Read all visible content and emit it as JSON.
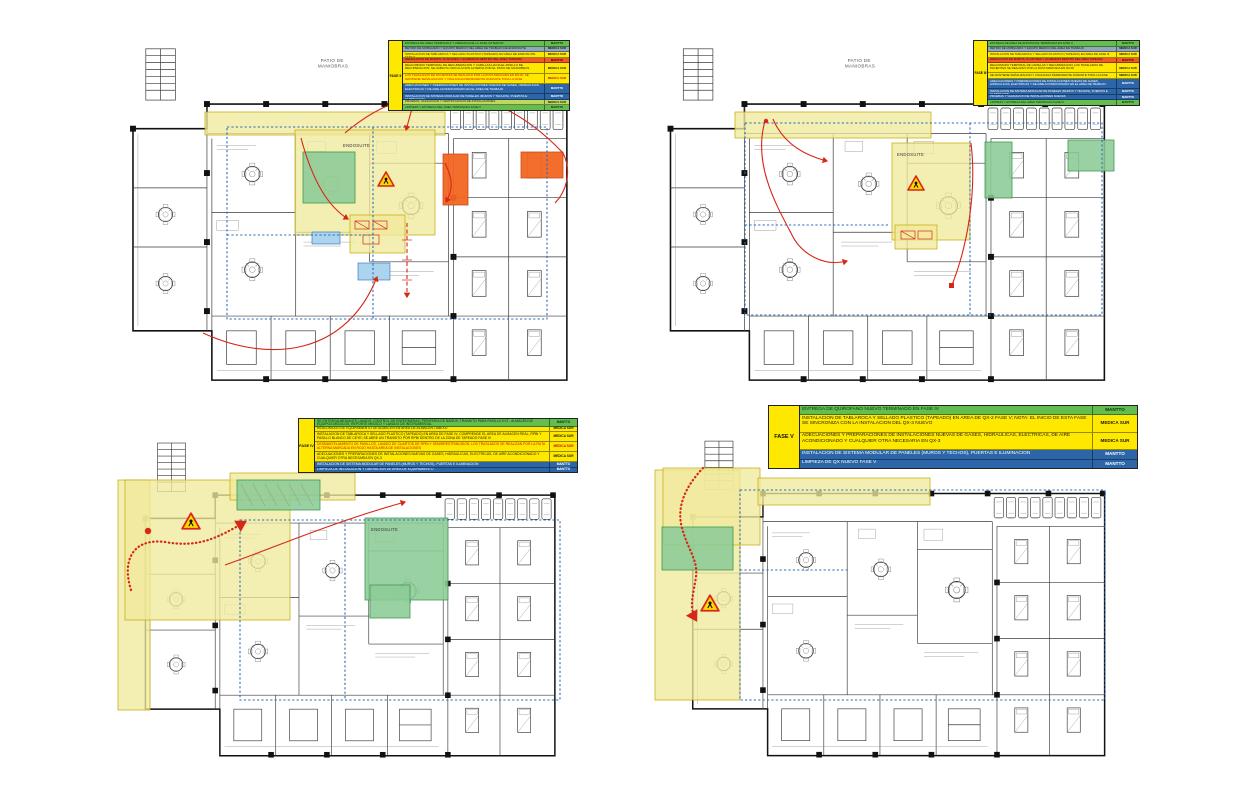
{
  "document": {
    "type": "hospital-renovation-phasing-plans",
    "background": "#ffffff"
  },
  "colors": {
    "legend_green": "#63BE4F",
    "legend_lightgreen": "#BCD85F",
    "legend_grayblue": "#93A7BB",
    "legend_yellow": "#FFE800",
    "legend_orange": "#F05A28",
    "legend_blue": "#2C66A9",
    "zone_yellow": "#EFE99B",
    "zone_green": "#8CCB96",
    "zone_orange": "#F26522",
    "zone_blue_note": "#A8D2EE",
    "route_red": "#D62718",
    "boundary_blue": "#2E6CB5",
    "warning_yellow": "#FFD800",
    "warning_red": "#D62718"
  },
  "plans": [
    {
      "name": "top-left",
      "patio_label_line1": "PATIO DE",
      "patio_label_line2": "MANIOBRAS",
      "endosuite_label": "ENDOSUITE",
      "legend": {
        "phase_label": "FASE II",
        "rows": [
          {
            "color": "green",
            "lines": 1,
            "text": "ENTREGA DE AREA TERMINADA Y LIBERADA DE LA FASE ANTERIOR",
            "resp": "MANTTO"
          },
          {
            "color": "grayblue",
            "lines": 1,
            "text": "RETIRO DE MOBILIARIO Y EQUIPO MEDICO DEL AREA DE TRABAJO DE ENDOSUITE",
            "resp": "MEDICA SUR"
          },
          {
            "color": "yellow",
            "lines": 1,
            "text": "INSTALACION DE TABLAROCA Y SELLADO PLASTICO (TAPEADO) EN AREA DE ENDOSUITE FASE II",
            "resp": "MEDICA SUR"
          },
          {
            "color": "orange",
            "lines": 1,
            "text": "DEMOLICION DE MUROS, PLAFONES Y ACABADOS DENTRO DEL AREA TAPEADA",
            "resp": "MANTTO"
          },
          {
            "color": "yellow",
            "lines": 2,
            "text": "REACOMODO TEMPORAL DE RECUPERACION Y CAMILLAS HACIA EL PASILLO DE RECUPERACION; SE HABILITA CIRCULACION ALTERNA POR EL PATIO DE MANIOBRAS",
            "resp": "MEDICA SUR"
          },
          {
            "color": "yellowred",
            "lines": 2,
            "text": "LOS TRASLADOS DE PACIENTES SE REALIZAN POR LA RUTA MARCADA EN ROJO; SE MANTIENE SEÑALIZACION Y VIGILANCIA PERMANENTE DURANTE TODA LA FASE",
            "resp": "MEDICA SUR"
          },
          {
            "color": "blue",
            "lines": 2,
            "text": "ADECUACIONES Y PREPARACIONES DE INSTALACIONES NUEVAS DE GASES, HIDRAULICAS, ELECTRICAS Y DE AIRE ACONDICIONADO EN EL AREA DE TRABAJO",
            "resp": "MANTTO"
          },
          {
            "color": "blue",
            "lines": 1,
            "text": "INSTALACION DE SISTEMA MODULAR DE PANELES (MUROS Y TECHOS), PUERTAS E ILUMINACION",
            "resp": "MANTTO"
          },
          {
            "color": "lightgreen",
            "lines": 1,
            "text": "PRUEBAS, VALIDACION Y CERTIFICACION DE INSTALACIONES",
            "resp": "MEDICA SUR"
          },
          {
            "color": "green",
            "lines": 1,
            "text": "LIMPIEZA Y ENTREGA DEL AREA TERMINADA FASE II",
            "resp": "MANTTO"
          }
        ]
      }
    },
    {
      "name": "top-right",
      "patio_label_line1": "PATIO DE",
      "patio_label_line2": "MANIOBRAS",
      "endosuite_label": "ENDOSUITE",
      "legend": {
        "phase_label": "FASE III",
        "rows": [
          {
            "color": "green",
            "lines": 1,
            "text": "ENTREGA DE AREA DE ENDOSUITE TERMINADA EN FASE II",
            "resp": "MANTTO"
          },
          {
            "color": "grayblue",
            "lines": 1,
            "text": "RETIRO DE MOBILIARIO Y EQUIPO MEDICO DEL AREA DE TRABAJO",
            "resp": "MEDICA SUR"
          },
          {
            "color": "yellow",
            "lines": 1,
            "text": "INSTALACION DE TABLAROCA Y SELLADO PLASTICO (TAPEADO) EN AREA DE FASE III",
            "resp": "MEDICA SUR"
          },
          {
            "color": "orange",
            "lines": 1,
            "text": "DEMOLICION DE MUROS, PLAFONES Y ACABADOS DENTRO DEL AREA TAPEADA",
            "resp": "MANTTO"
          },
          {
            "color": "yellow",
            "lines": 2,
            "text": "REACOMODO TEMPORAL DE CAMILLAS Y RECUPERACION; LOS TRASLADOS DE PACIENTES SE REALIZAN POR LA RUTA MARCADA EN ROJO",
            "resp": "MEDICA SUR"
          },
          {
            "color": "yellow",
            "lines": 1,
            "text": "SE MANTIENE SEÑALIZACION Y VIGILANCIA PERMANENTE DURANTE TODA LA FASE",
            "resp": "MEDICA SUR"
          },
          {
            "color": "blue",
            "lines": 2,
            "text": "ADECUACIONES Y PREPARACIONES DE INSTALACIONES NUEVAS DE GASES, HIDRAULICAS, ELECTRICAS Y DE AIRE ACONDICIONADO EN EL AREA DE TRABAJO",
            "resp": "MANTTO"
          },
          {
            "color": "blue",
            "lines": 1,
            "text": "INSTALACION DE SISTEMA MODULAR DE PANELES (MUROS Y TECHOS), PUERTAS E ILUMINACION",
            "resp": "MANTTO"
          },
          {
            "color": "blue",
            "lines": 1,
            "text": "PRUEBAS Y VALIDACION DE INSTALACIONES NUEVAS",
            "resp": "MANTTO"
          },
          {
            "color": "green",
            "lines": 1,
            "text": "LIMPIEZA Y ENTREGA DEL AREA TERMINADA FASE III",
            "resp": "MANTTO"
          }
        ]
      }
    },
    {
      "name": "bottom-left",
      "endosuite_label": "ENDOSUITE",
      "legend": {
        "phase_label": "FASE IV",
        "rows": [
          {
            "color": "green",
            "lines": 1.5,
            "text": "SE ENTREGA MEDIANTE LAVADO: CONTROL DE ENFERMERAS, PERIFERIA DE BAÑOS, TRANSITO PARA PASILLO EXT., ALMACEN DE EQUIPOS MEDICOS, REPORTE MEDICO Y LAVADO DE INSTRUMENTAL",
            "resp": "MANTTO"
          },
          {
            "color": "yellow",
            "lines": 1,
            "text": "REACOMODO DE EQUIPAMIENTO DE ALMACEN EN AREA DE ALMACEN / ANEXO",
            "resp": "MEDICA SUR"
          },
          {
            "color": "yellow",
            "lines": 2,
            "text": "INSTALACION DE TABLAROCA Y SELLADO PLASTICO (TAPEADO) EN AREA DE FASE IV; COMPRENDE EL AREA DE ALMACEN REAL, RPBI Y PASILLO BLANCO DE CEYE; SE ABRE UN TRANSITO POR RPBI DENTRO DE LA ZONA DE TAPEADO FASE IV",
            "resp": "MEDICA SUR"
          },
          {
            "color": "yellowred",
            "lines": 2,
            "text": "DESMANTELAMIENTO DE PASILLOS, LAVADO DE CUARTOS DE RPBI Y SEMIRRESTRINGIDOS; LOS TRASLADOS SE REALIZAN POR LA RUTA ALTERNA MARCADA EN ROJO HASTA AREA DE INSTALACIONES",
            "resp": "MEDICA SUR"
          },
          {
            "color": "yellow",
            "lines": 2,
            "text": "ADECUACIONES Y PREPARACIONES DE INSTALACIONES NUEVAS DE GASES, HIDRAULICAS, ELECTRICAS, DE AIRE ACONDICIONADO Y CUALQUIER OTRA NECESARIA EN QX-3",
            "resp": "MEDICA SUR"
          },
          {
            "color": "blue",
            "lines": 1,
            "text": "INSTALACION DE SISTEMA MODULAR DE PANELES (MUROS Y TECHOS), PUERTAS E ILUMINACION",
            "resp": "MANTTO"
          },
          {
            "color": "blue",
            "lines": 1,
            "text": "LIMPIEZA DE INSTALACION Y LIBERACION DE AREA DE EQUIPAMIENTO",
            "resp": "MANTTO"
          }
        ]
      }
    },
    {
      "name": "bottom-right",
      "legend": {
        "phase_label": "FASE V",
        "rows": [
          {
            "color": "green",
            "lines": 1,
            "text": "ENTREGA DE QUIROFANO NUEVO TERMINADO EN FASE IV",
            "resp": "MANTTO"
          },
          {
            "color": "yellow",
            "lines": 2,
            "text": "INSTALACION DE TABLAROCA Y SELLADO PLASTICO (TAPEADO) EN AREA DE QX-2 FASE V; NOTA: EL INICIO DE ESTA FASE SE SINCRONIZA CON LA INSTALACION DEL QX-3 NUEVO",
            "resp": "MEDICA SUR"
          },
          {
            "color": "yellow",
            "lines": 2,
            "text": "ADECUACIONES Y PREPARACIONES DE INSTALACIONES NUEVAS DE GASES, HIDRAULICAS, ELECTRICAS, DE AIRE ACONDICIONADO Y CUALQUIER OTRA NECESARIA EN QX-3",
            "resp": "MEDICA SUR"
          },
          {
            "color": "blue",
            "lines": 1,
            "text": "INSTALACION DE SISTEMA MODULAR DE PANELES (MUROS Y TECHOS), PUERTAS E ILUMINACION",
            "resp": "MANTTO"
          },
          {
            "color": "blue",
            "lines": 1,
            "text": "LIMPIEZA DE QX NUEVO FASE V",
            "resp": "MANTTO"
          }
        ]
      }
    }
  ]
}
